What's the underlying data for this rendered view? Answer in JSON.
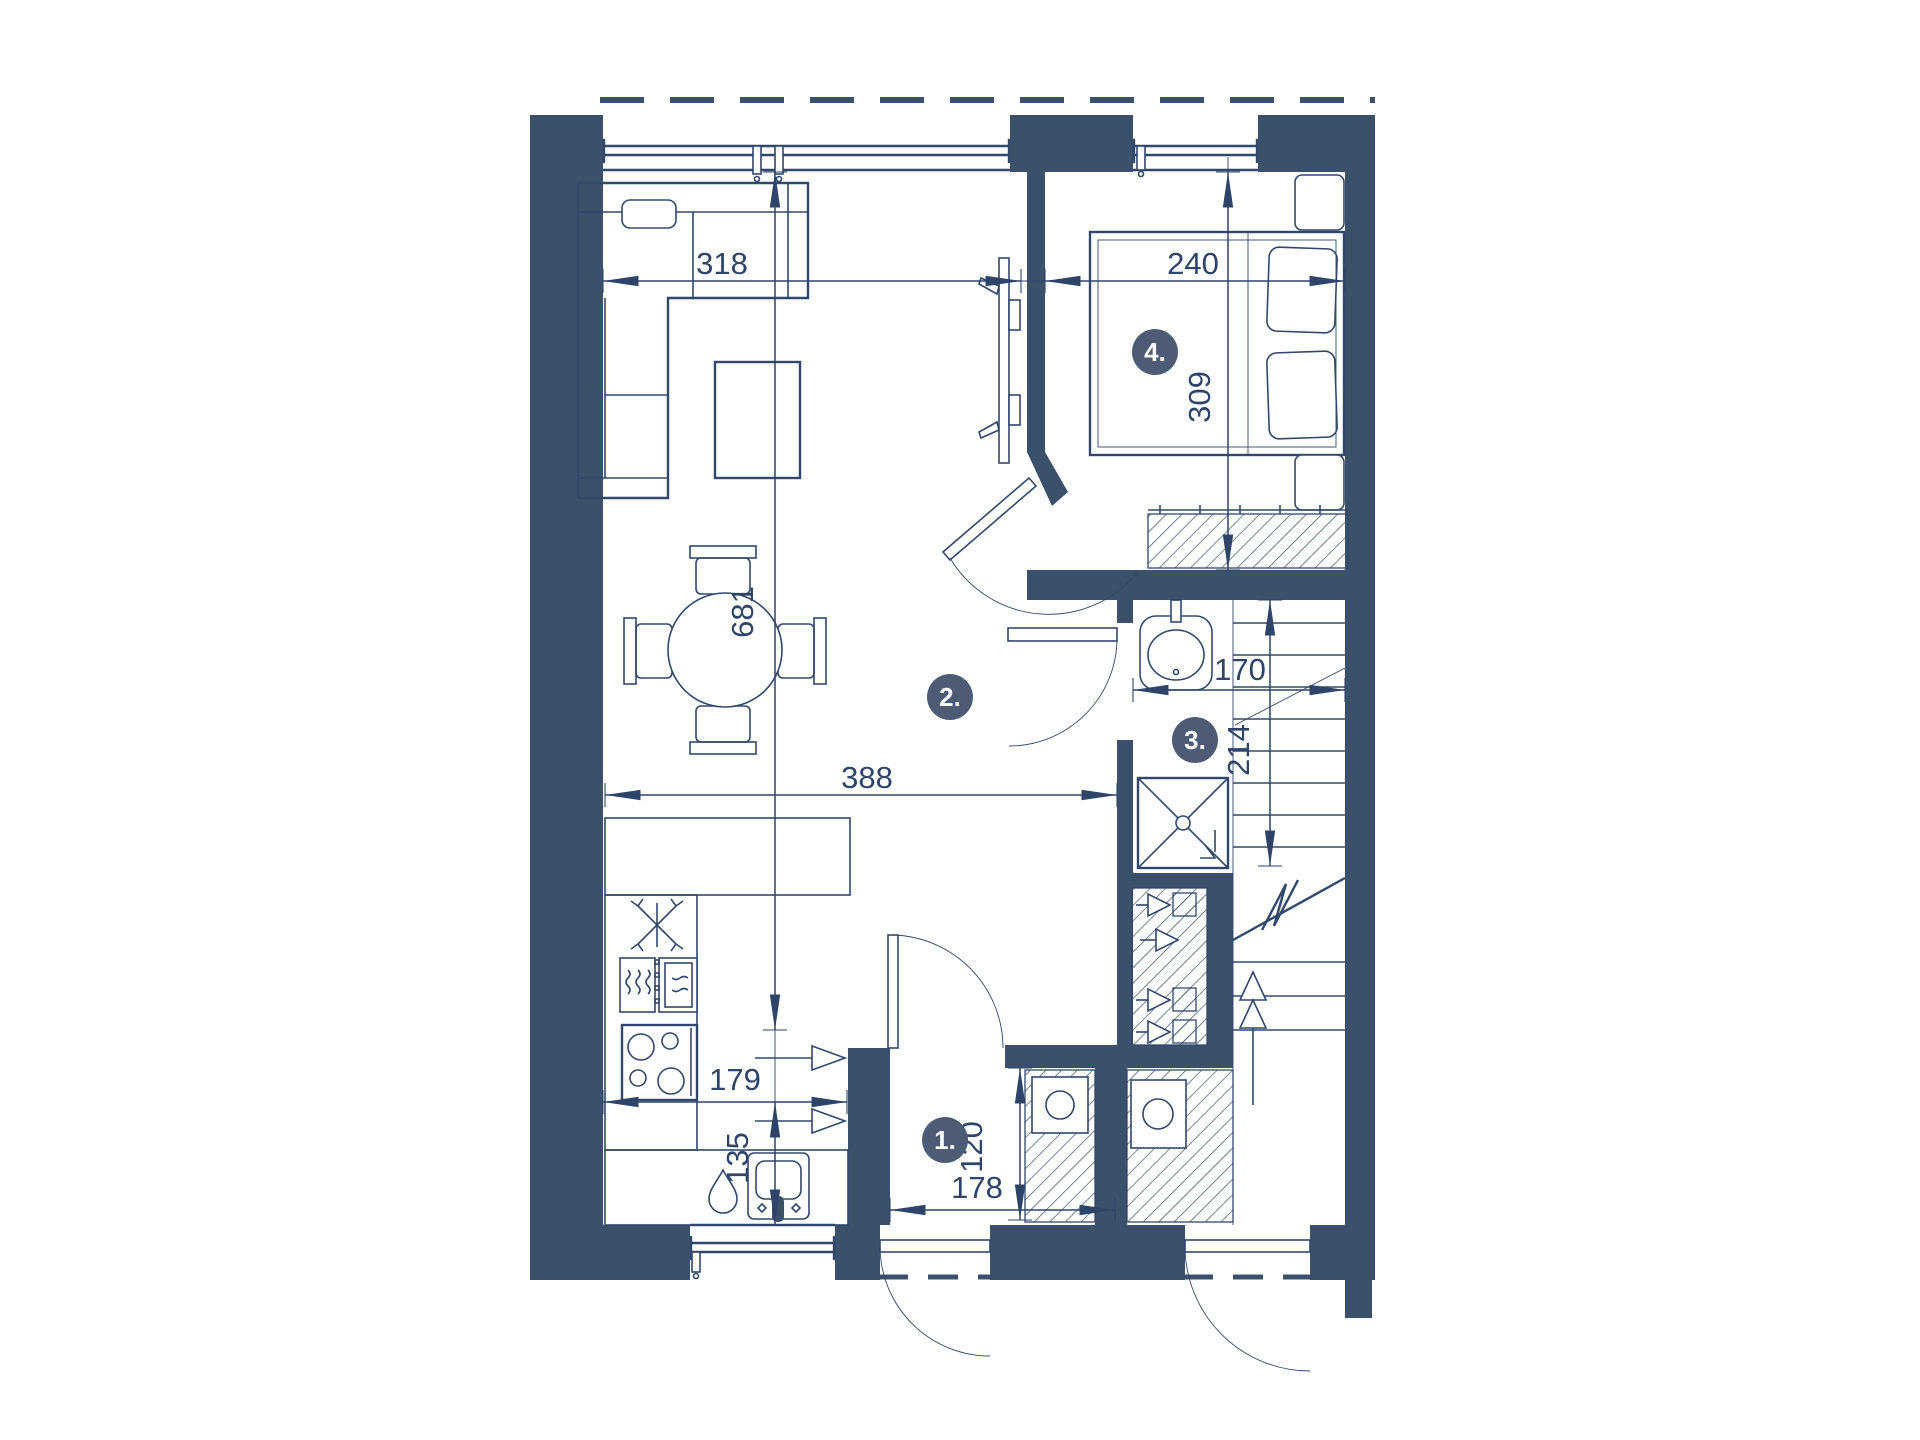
{
  "plan": {
    "title": "apartment-floor-plan",
    "rooms": [
      {
        "number": "1.",
        "key": "entrance-hall"
      },
      {
        "number": "2.",
        "key": "living-kitchen"
      },
      {
        "number": "3.",
        "key": "bathroom"
      },
      {
        "number": "4.",
        "key": "bedroom"
      }
    ],
    "dims": {
      "d318": "318",
      "d240": "240",
      "d309": "309",
      "d681": "681",
      "d170": "170",
      "d214": "214",
      "d388": "388",
      "d179": "179",
      "d135": "135",
      "d120": "120",
      "d178": "178"
    },
    "colors": {
      "wall": "#3A506B",
      "line": "#31486B",
      "dimension": "#2E4468",
      "room_badge": "#4D5C74",
      "background": "#FFFFFF"
    }
  }
}
